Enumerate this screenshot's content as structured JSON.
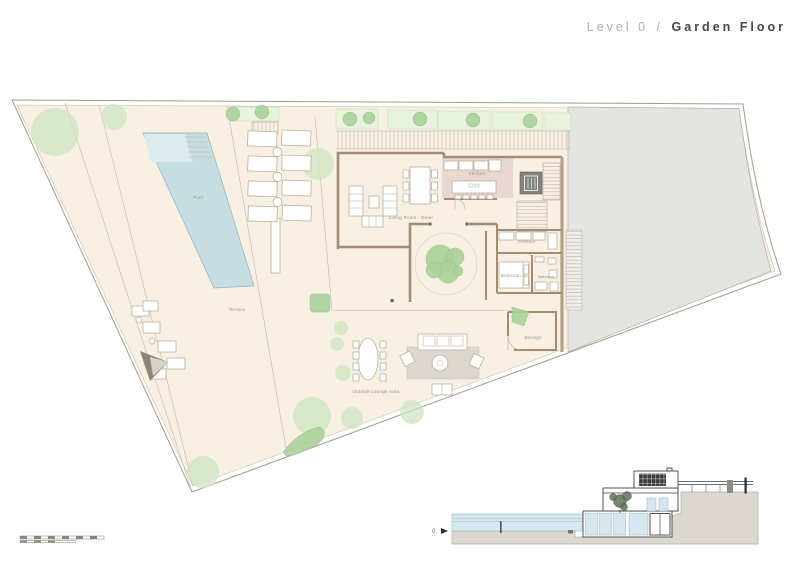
{
  "header": {
    "level_label": "Level 0",
    "separator": "/",
    "floor_name": "Garden Floor"
  },
  "plan": {
    "labels": {
      "pool": "Pool",
      "terrace": "Terrace",
      "outside_lounge": "Outside Lounge Area",
      "living_room": "Living Room · Diner",
      "kitchen": "Kitchen",
      "dresser": "Dresser",
      "bedroom4": "Bedroom 4",
      "bathroom": "Bathroom",
      "storage": "Storage"
    }
  },
  "section": {
    "level_marker": "0"
  },
  "colors": {
    "site_fill": "#f8f0e3",
    "neighbor_fill": "#e4e4e1",
    "pool_fill": "#c6dee1",
    "pool_shallow": "#dcebed",
    "wall": "#a48b72",
    "wall_tan": "#b2a28a",
    "kitchen_fill": "#e9d8d2",
    "green": "#cfe4c3",
    "green_dark": "#abd29a",
    "planter_fill": "#e8f2dd",
    "furniture_stroke": "#b2a795",
    "label_text": "#9c9083",
    "rug_fill": "#dcd8cf",
    "lift_fill": "#85837d",
    "section_dark": "#3a3a38",
    "glass": "#d6e7f0",
    "ground": "#dcd8d1",
    "title_muted": "#b3afa8",
    "title_dark": "#474743",
    "boundary_line": "#a59d8e"
  }
}
